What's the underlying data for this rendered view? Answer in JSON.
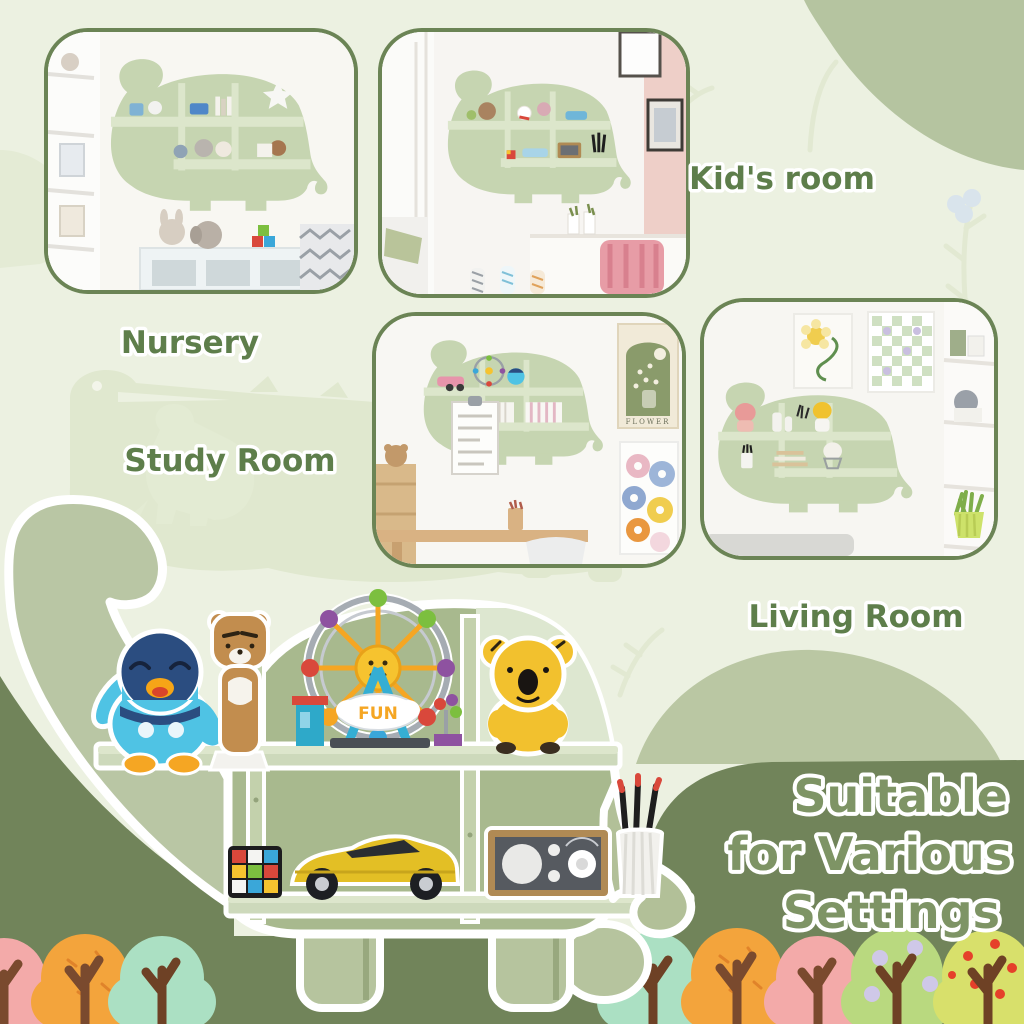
{
  "poster": {
    "type": "product-lifestyle-collage",
    "product": "dinosaur-shaped wall shelf"
  },
  "headline": {
    "line1": "Suitable",
    "line2": "for Various",
    "line3": "Settings"
  },
  "room_labels": {
    "nursery": "Nursery",
    "kids_room": "Kid's room",
    "study_room": "Study Room",
    "living_room": "Living Room"
  },
  "photos": [
    {
      "id": "nursery",
      "scene": "green dinosaur shelf with plush toys above a nursery dresser"
    },
    {
      "id": "kids-room",
      "scene": "green dinosaur shelf beside a white desk with pink chair"
    },
    {
      "id": "study-room",
      "scene": "green dinosaur shelf with books next to flower posters and wooden desk"
    },
    {
      "id": "living-room",
      "scene": "green dinosaur shelf with figurines beside white shelving"
    }
  ],
  "big_shelf": {
    "fun_sign": "FUN",
    "items": [
      "piplup-penguin-figure",
      "ryan-bear-figure",
      "lego-ferris-wheel",
      "koala-figure",
      "rubiks-cube",
      "yellow-sports-car",
      "wooden-radio",
      "pencil-holder-with-pencils"
    ]
  },
  "study_poster_text": "FLOWER",
  "colors": {
    "background": "#ecf1e1",
    "watermark": "#e0e8cf",
    "sage_blob": "#b5c4a0",
    "dark_green": "#71845a",
    "photo_border": "#6b8455",
    "label_green": "#5e7e4b",
    "headline_green": "#7e9465",
    "shelf_neck": "#b9c6a4",
    "shelf_body": "#a8b98e",
    "shelf_board": "#cdd9bb"
  },
  "bottom_trees": [
    {
      "color": "pink"
    },
    {
      "color": "orange"
    },
    {
      "color": "mint"
    },
    {
      "color": "mint"
    },
    {
      "color": "orange"
    },
    {
      "color": "pink"
    },
    {
      "color": "green-with-lavender-dots"
    },
    {
      "color": "apple-with-red-dots"
    }
  ]
}
